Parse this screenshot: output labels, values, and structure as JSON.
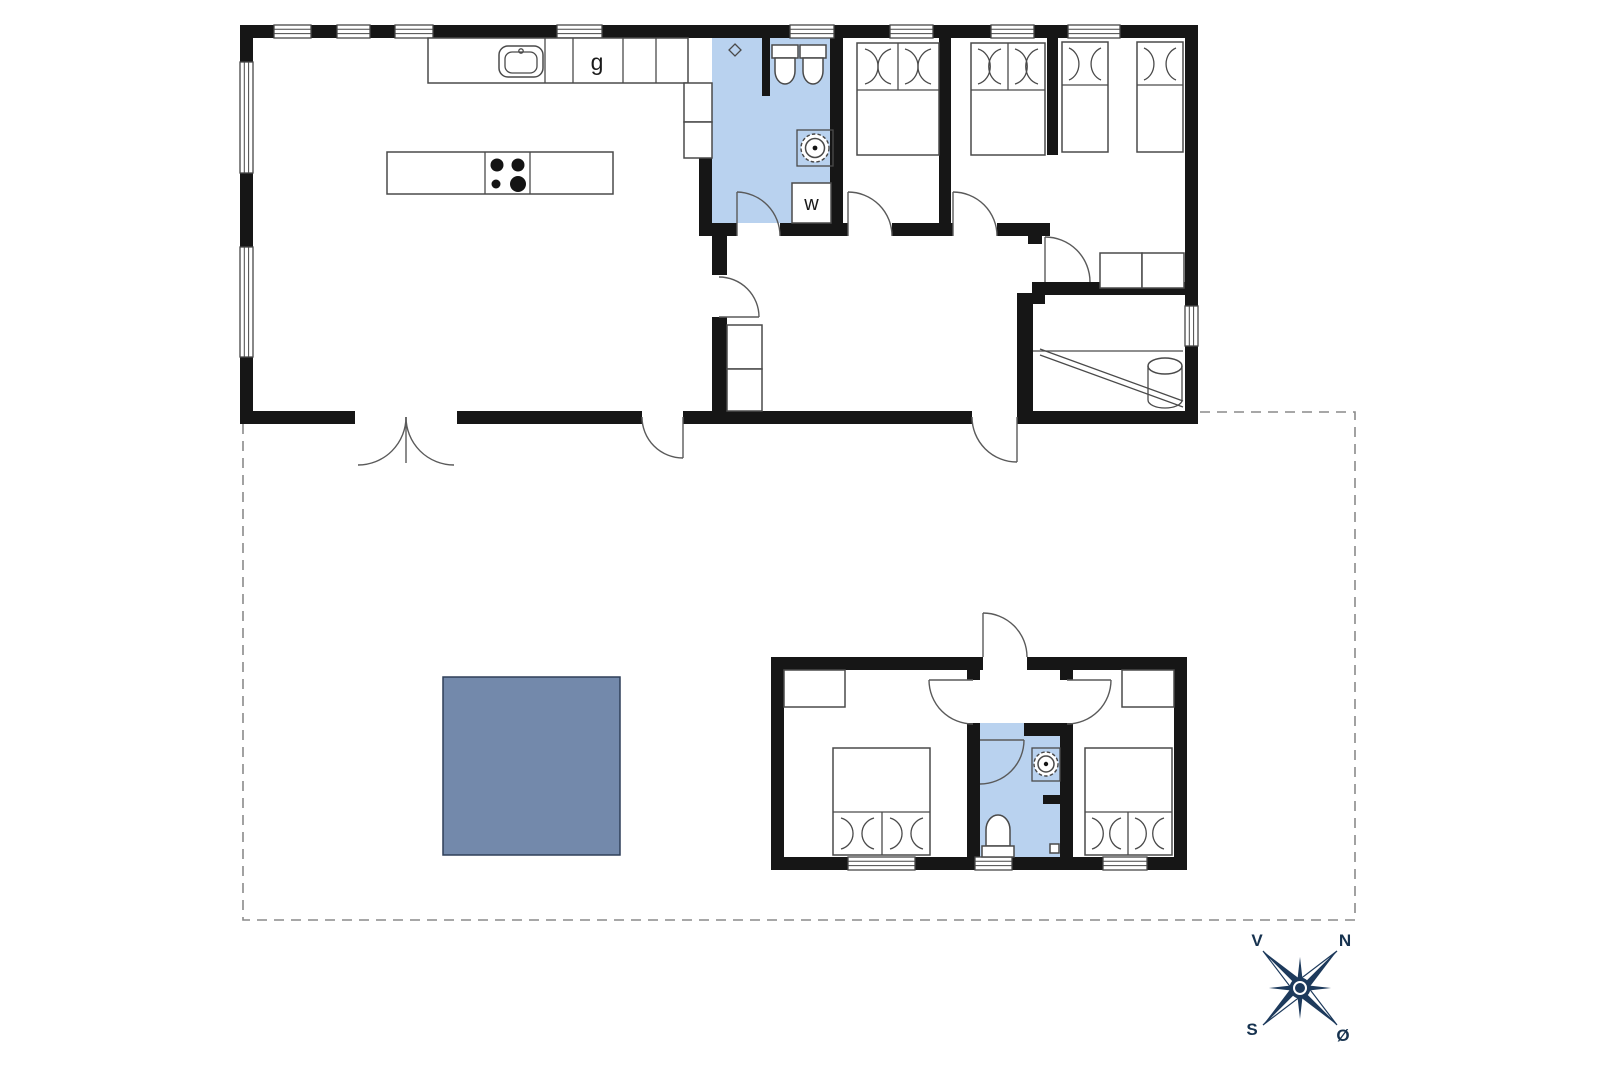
{
  "labels": {
    "stove": "g",
    "washing_machine": "w"
  },
  "compass": {
    "west": "V",
    "north": "N",
    "south": "S",
    "east": "Ø"
  },
  "colors": {
    "wall": "#161616",
    "bathroom": "#b9d2ef",
    "terrace": "#7389ab",
    "compass": "#1d3a5c"
  }
}
